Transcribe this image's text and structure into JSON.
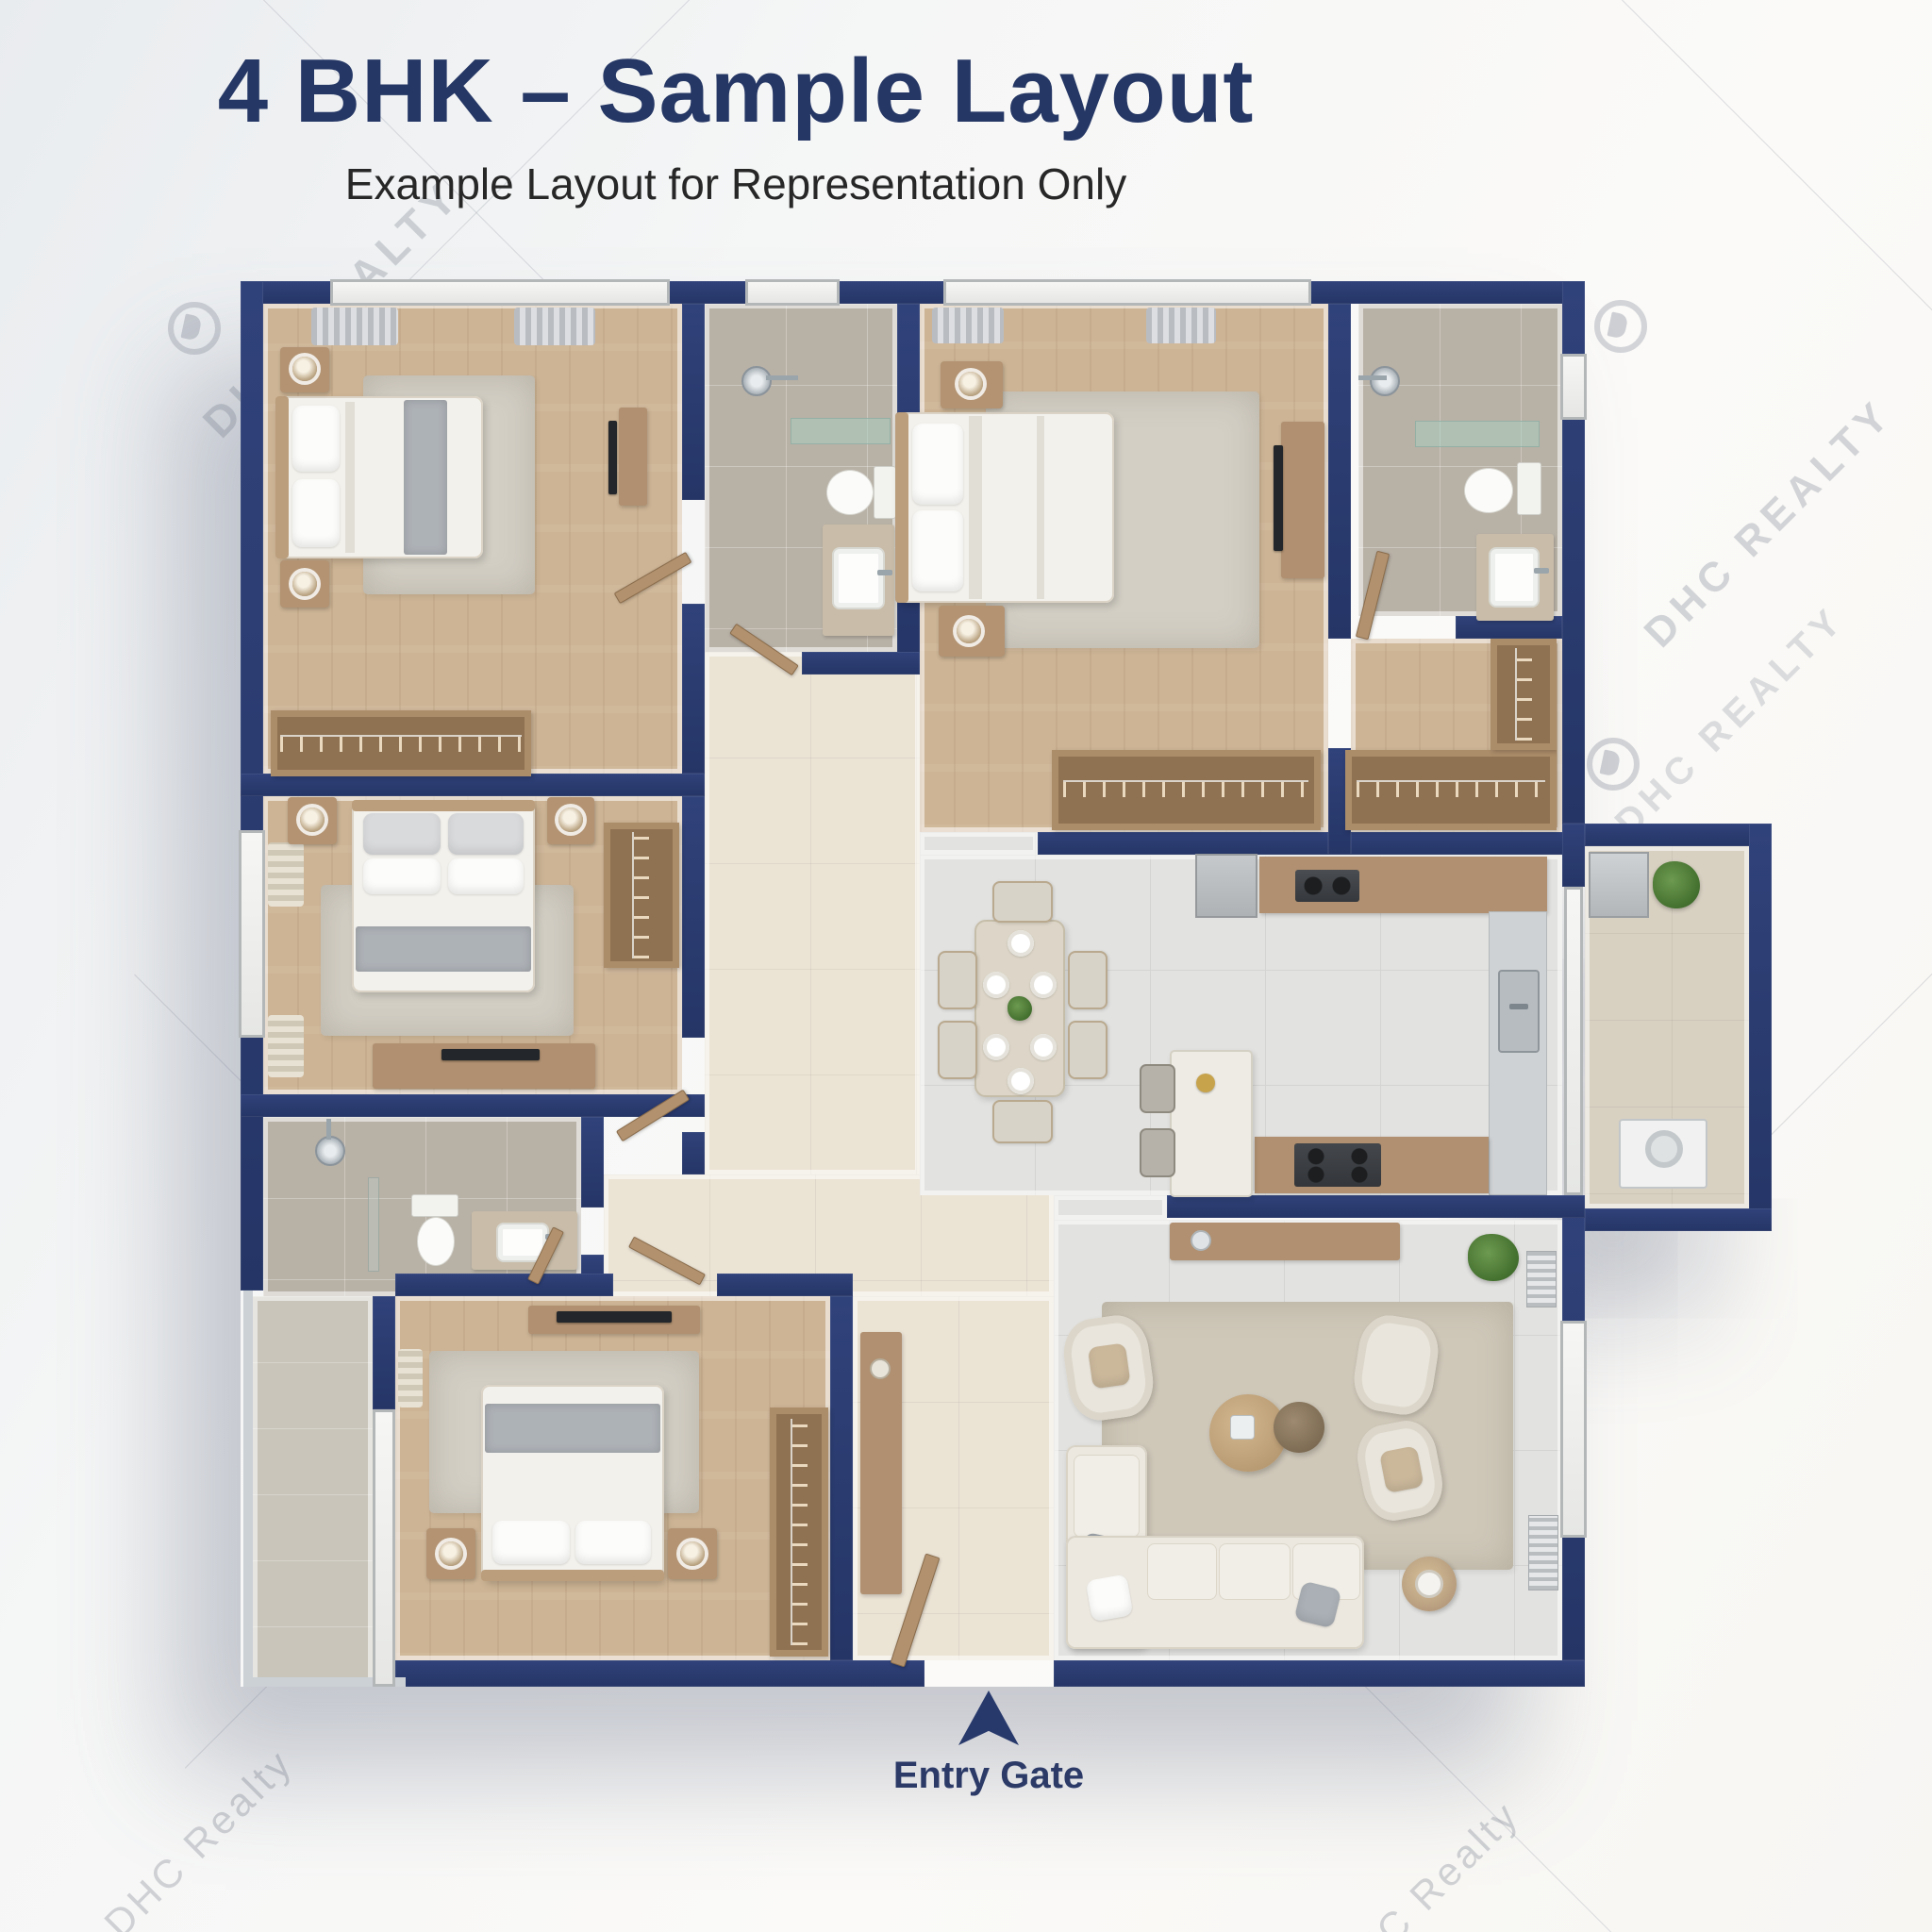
{
  "header": {
    "title": "4 BHK – Sample Layout",
    "subtitle": "Example Layout for Representation Only"
  },
  "entry_marker": {
    "label": "Entry Gate",
    "arrow": "up-triangle"
  },
  "watermarks": {
    "brand_upper": "DHC REALTY",
    "brand_mixed": "DHC Realty",
    "logo": "dhc-circle-logo"
  },
  "palette": {
    "wall_navy": "#2a3a6b",
    "title_navy": "#253765",
    "wood_floor": "#cdb495",
    "tile_light": "#e2e2e0",
    "tile_bath": "#b8b1a6",
    "tile_cream": "#ebe3d4",
    "rug": "#d3cfc5",
    "furniture_wood": "#b09070",
    "fixture_white": "#fbfbf9",
    "glass_green": "#aacdc0",
    "plant_green": "#44702f",
    "accent_gold": "#c7a34c"
  }
}
